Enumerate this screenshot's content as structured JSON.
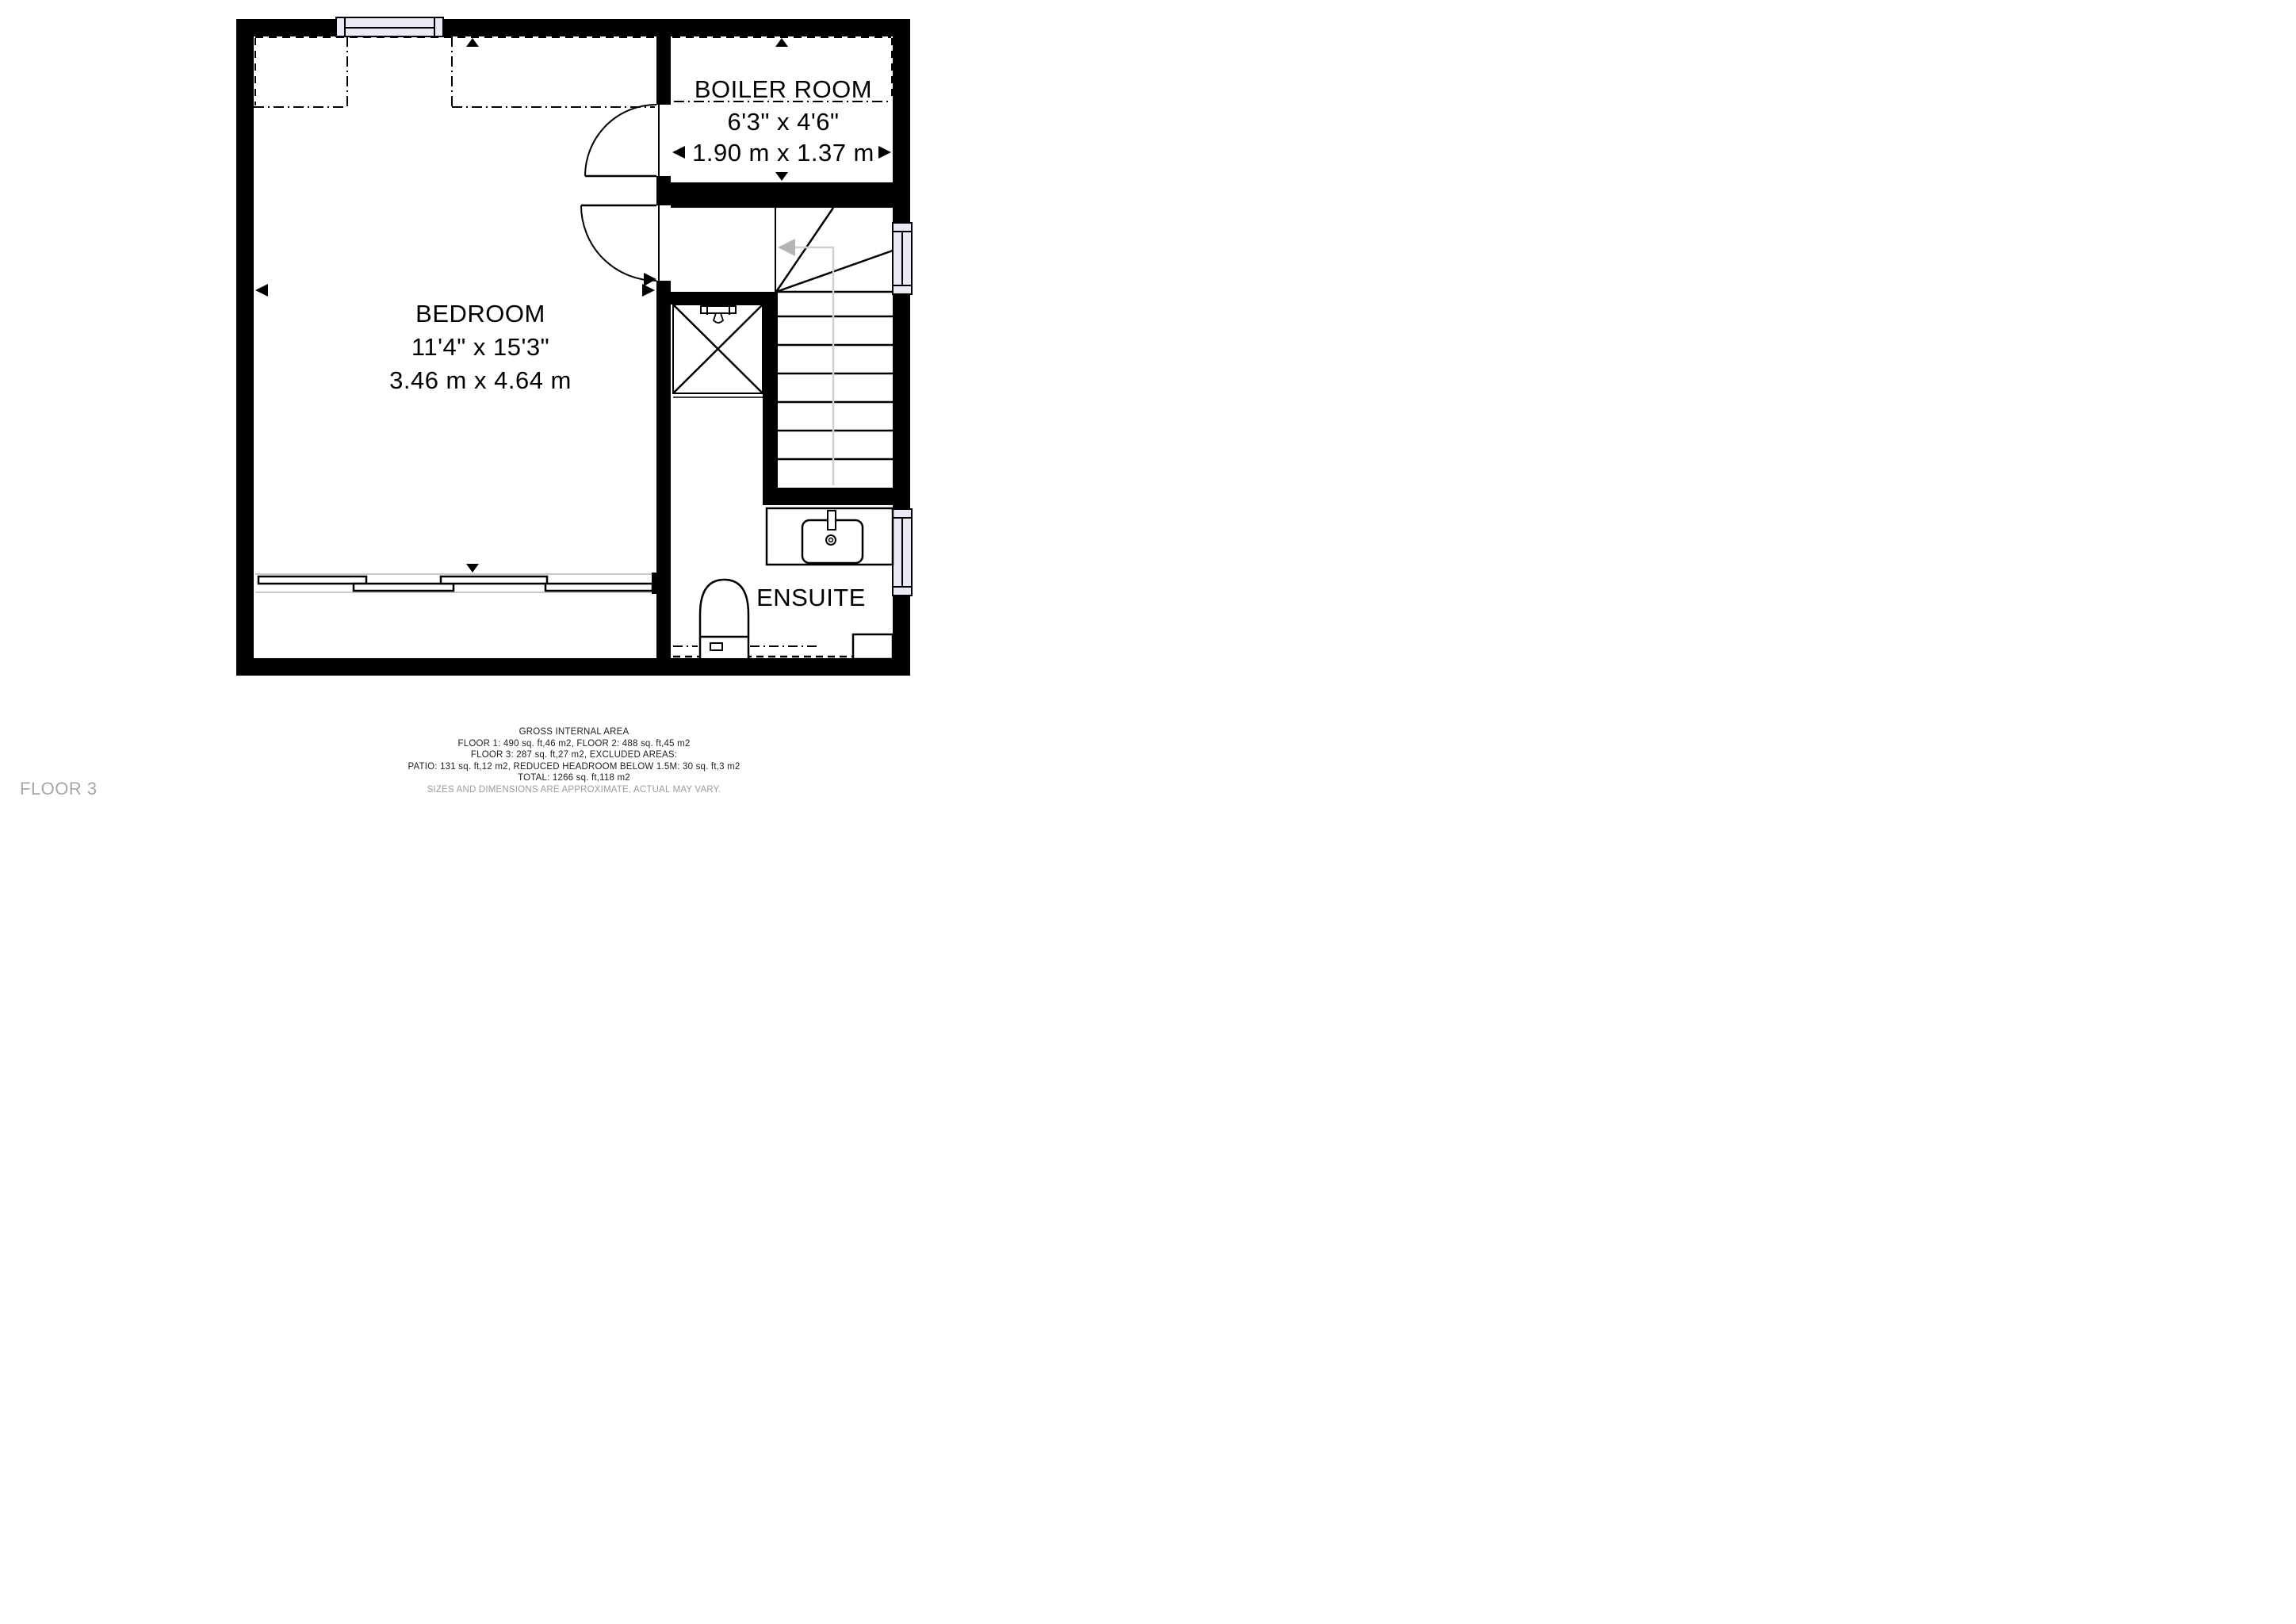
{
  "floor_plan": {
    "floor_label": "FLOOR 3",
    "bedroom": {
      "label": "BEDROOM",
      "dim_imperial": "11'4\" x 15'3\"",
      "dim_metric": "3.46 m x 4.64 m"
    },
    "boiler_room": {
      "label": "BOILER ROOM",
      "dim_imperial": "6'3\" x 4'6\"",
      "dim_metric": "1.90 m x 1.37 m"
    },
    "ensuite": {
      "label": "ENSUITE"
    }
  },
  "footer": {
    "title": "GROSS INTERNAL AREA",
    "line1": "FLOOR 1: 490 sq. ft,46 m2, FLOOR 2: 488 sq. ft,45 m2",
    "line2": "FLOOR 3: 287 sq. ft,27 m2, EXCLUDED AREAS:",
    "line3": "PATIO: 131 sq. ft,12 m2, REDUCED HEADROOM BELOW 1.5M: 30 sq. ft,3 m2",
    "line4": "TOTAL: 1266 sq. ft,118 m2",
    "disclaimer": "SIZES AND DIMENSIONS ARE APPROXIMATE, ACTUAL MAY VARY."
  },
  "colors": {
    "wall": "#000000",
    "window_fill": "#e9e9f8",
    "walk_line": "#d0d0d0",
    "walk_arrow": "#b5b5b5"
  }
}
